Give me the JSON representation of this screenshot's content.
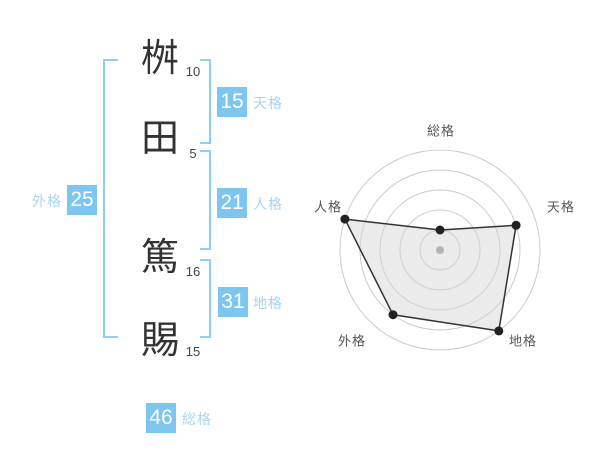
{
  "page": {
    "background": "#ffffff"
  },
  "name_panel": {
    "characters": [
      {
        "char": "桝",
        "strokes": "10"
      },
      {
        "char": "田",
        "strokes": "5"
      },
      {
        "char": "篤",
        "strokes": "16"
      },
      {
        "char": "賜",
        "strokes": "15"
      }
    ],
    "badges": {
      "tenkaku": {
        "value": "15",
        "label": "天格"
      },
      "jinkaku": {
        "value": "21",
        "label": "人格"
      },
      "chikaku": {
        "value": "31",
        "label": "地格"
      },
      "gaikaku": {
        "value": "25",
        "label": "外格"
      },
      "soukaku": {
        "value": "46",
        "label": "総格"
      }
    },
    "colors": {
      "badge_bg": "#7cc6f0",
      "badge_text": "#ffffff",
      "label_text": "#a8d4f0",
      "bracket": "#8ecff4",
      "character_text": "#333333",
      "stroke_count_text": "#444444"
    }
  },
  "chart_data": {
    "type": "radar",
    "title": "",
    "axes": [
      "総格",
      "天格",
      "地格",
      "外格",
      "人格"
    ],
    "axis_values": {
      "総格": 46,
      "天格": 15,
      "地格": 31,
      "外格": 25,
      "人格": 21
    },
    "values_ring": [
      1,
      4,
      5,
      4,
      5
    ],
    "ring_max": 5,
    "angles_deg": [
      90,
      18,
      -54,
      -126,
      162
    ],
    "radii_px": [
      20,
      80,
      100,
      80,
      100
    ],
    "grid_rings_px": [
      20,
      40,
      60,
      80,
      100
    ],
    "center_px": {
      "x": 140,
      "y": 140
    },
    "label_offsets_px": [
      {
        "x": 1,
        "y": -119
      },
      {
        "x": 121,
        "y": -43
      },
      {
        "x": 83,
        "y": 91
      },
      {
        "x": -88,
        "y": 91
      },
      {
        "x": -112,
        "y": -43
      }
    ],
    "grid": "circular",
    "legend": "none",
    "colors": {
      "grid": "#cccccc",
      "polygon_stroke": "#333333",
      "polygon_fill": "rgba(210,210,210,0.45)",
      "marker": "#222222",
      "center_dot": "#b5b5b5",
      "axis_label": "#555555"
    }
  }
}
